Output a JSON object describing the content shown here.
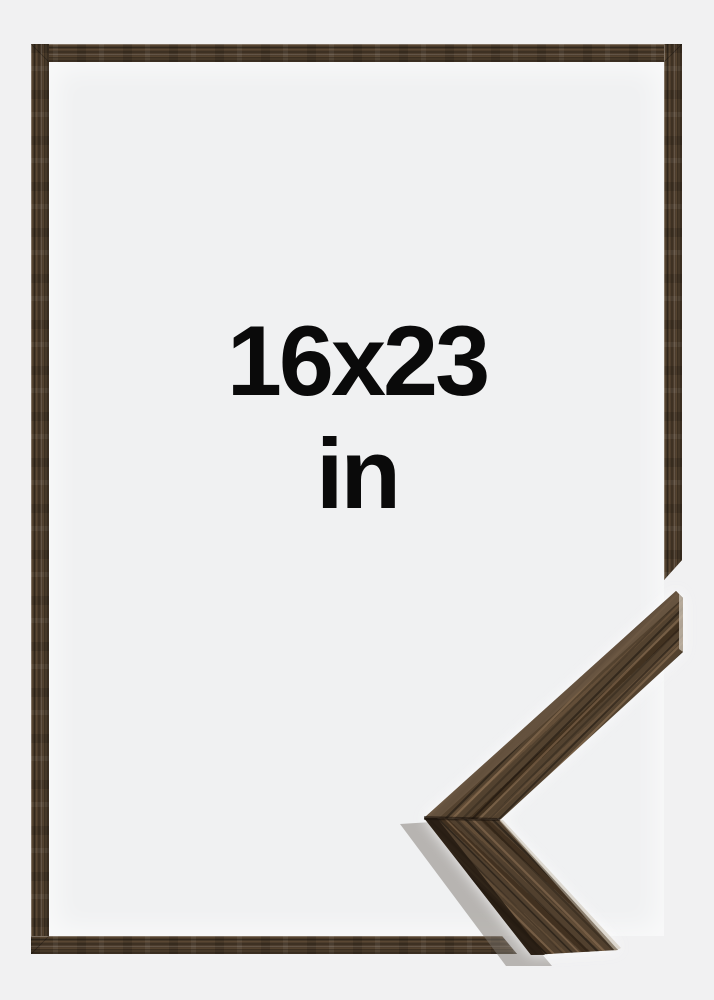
{
  "product": {
    "size_label": "16x23",
    "unit_label": "in"
  },
  "colors": {
    "backdrop": "#f1f1f2",
    "interior": "#f0f1f2",
    "frame_wood_base": "#4a3a2b",
    "frame_wood_dark": "#3e3123",
    "frame_wood_light": "#5a4733",
    "corner_wood_base": "#53422f",
    "corner_wood_highlight": "#7c6750",
    "corner_wood_shadow": "#231a11",
    "text": "#0a0a0a"
  }
}
